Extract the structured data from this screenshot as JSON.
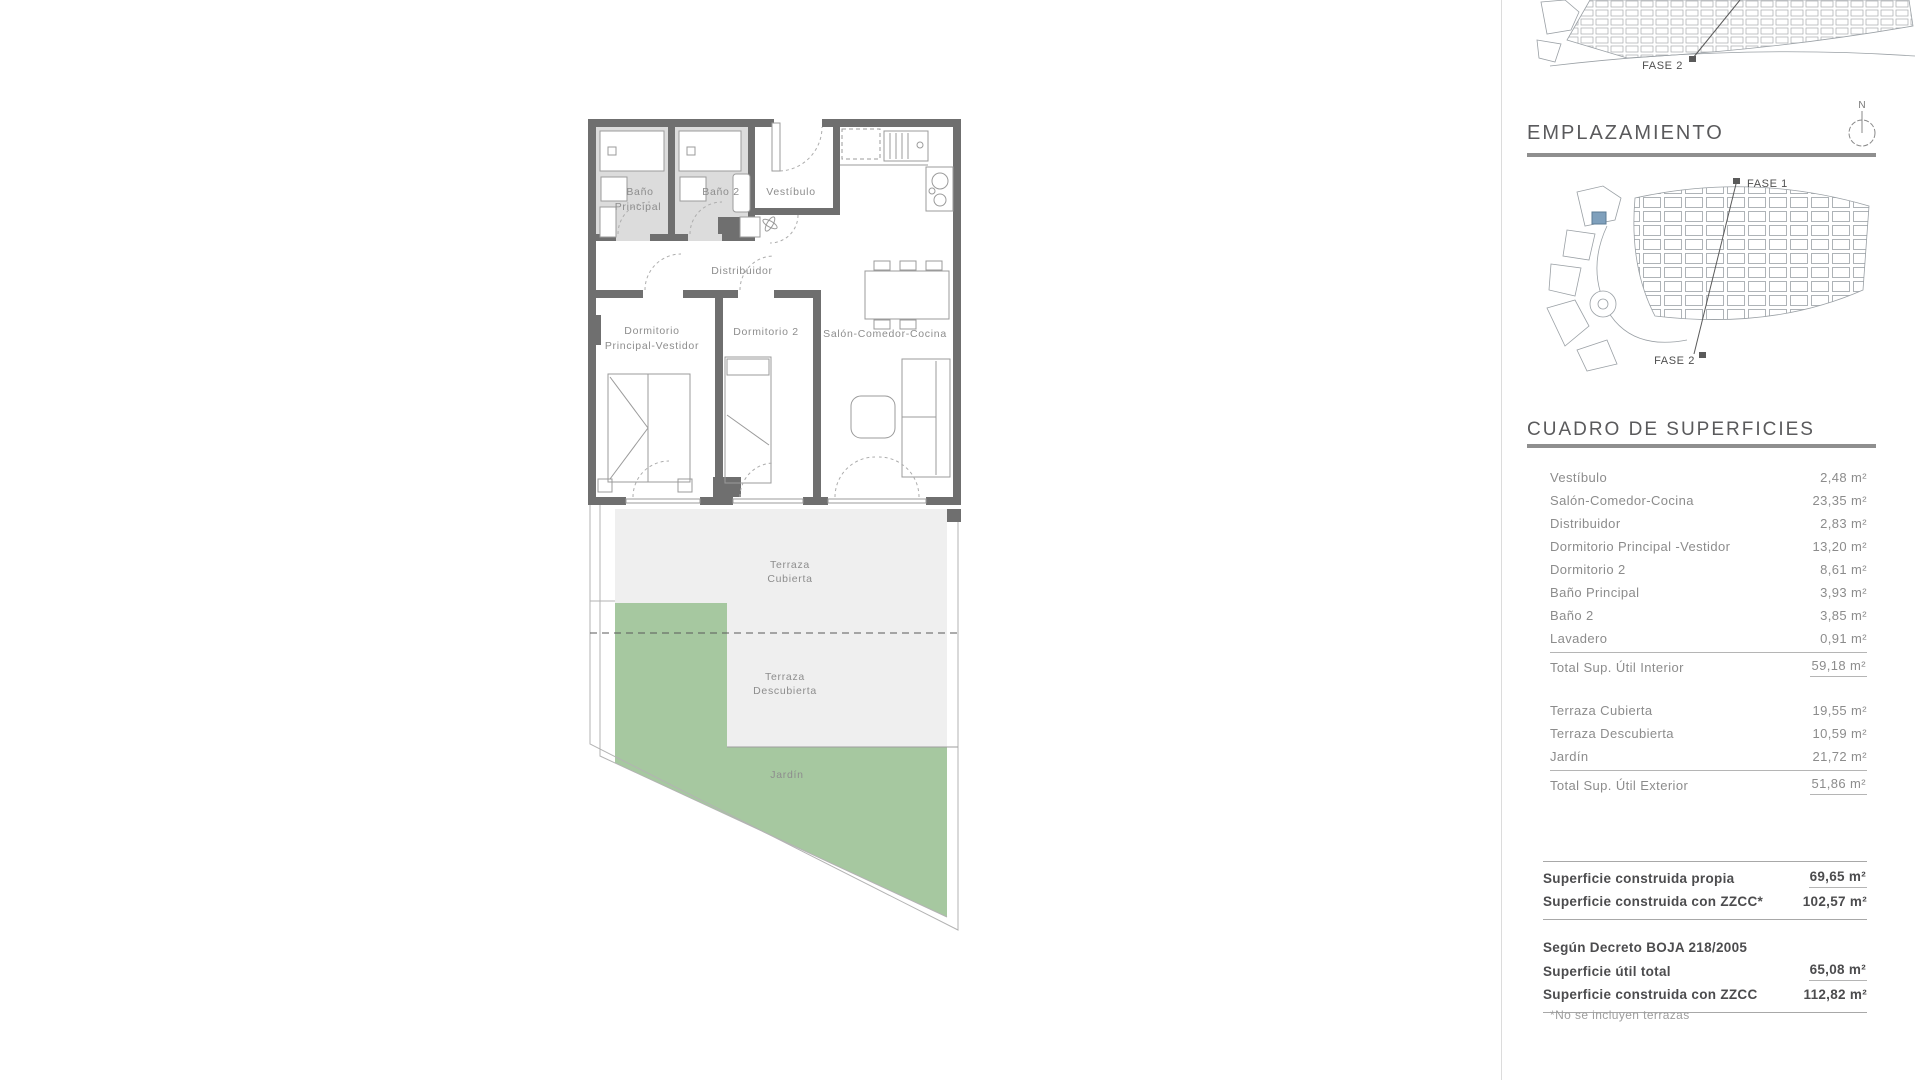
{
  "floor_plan": {
    "rooms": {
      "bano_principal_l1": "Baño",
      "bano_principal_l2": "Principal",
      "bano2": "Baño 2",
      "vestibulo": "Vestíbulo",
      "distribuidor": "Distribuidor",
      "dorm_principal_l1": "Dormitorio",
      "dorm_principal_l2": "Principal-Vestidor",
      "dorm2": "Dormitorio 2",
      "salon": "Salón-Comedor-Cocina",
      "terraza_cubierta_l1": "Terraza",
      "terraza_cubierta_l2": "Cubierta",
      "terraza_descubierta_l1": "Terraza",
      "terraza_descubierta_l2": "Descubierta",
      "jardin": "Jardín"
    }
  },
  "site": {
    "top_map_fase2": "FASE 2",
    "emplazamiento_title": "EMPLAZAMIENTO",
    "north_label": "N",
    "fase1": "FASE 1",
    "fase2": "FASE 2"
  },
  "surfaces": {
    "title": "CUADRO DE SUPERFICIES",
    "interior": {
      "rows": [
        {
          "label": "Vestíbulo",
          "value": "2,48 m²"
        },
        {
          "label": "Salón-Comedor-Cocina",
          "value": "23,35 m²"
        },
        {
          "label": "Distribuidor",
          "value": "2,83 m²"
        },
        {
          "label": "Dormitorio Principal -Vestidor",
          "value": "13,20 m²"
        },
        {
          "label": "Dormitorio 2",
          "value": "8,61 m²"
        },
        {
          "label": "Baño Principal",
          "value": "3,93 m²"
        },
        {
          "label": "Baño 2",
          "value": "3,85 m²"
        },
        {
          "label": "Lavadero",
          "value": "0,91 m²"
        }
      ],
      "total": {
        "label": "Total Sup. Útil Interior",
        "value": "59,18 m²"
      }
    },
    "exterior": {
      "rows": [
        {
          "label": "Terraza Cubierta",
          "value": "19,55 m²"
        },
        {
          "label": "Terraza Descubierta",
          "value": "10,59 m²"
        },
        {
          "label": "Jardín",
          "value": "21,72 m²"
        }
      ],
      "total": {
        "label": "Total Sup. Útil Exterior",
        "value": "51,86 m²"
      }
    },
    "construida": {
      "rows": [
        {
          "label": "Superficie construida propia",
          "value": "69,65 m²"
        },
        {
          "label": "Superficie construida con ZZCC*",
          "value": "102,57 m²"
        }
      ]
    },
    "decreto": {
      "heading": "Según Decreto BOJA 218/2005",
      "rows": [
        {
          "label": "Superficie útil total",
          "value": "65,08 m²"
        },
        {
          "label": "Superficie construida con ZZCC",
          "value": "112,82 m²"
        }
      ]
    },
    "footnote": "*No se incluyen terrazas"
  },
  "colors": {
    "accent_blue": "#7fa0bc",
    "wall_gray": "#6f6f6f",
    "bath_floor": "#dcdcdc",
    "terrace_gray": "#efefef",
    "garden_green": "#a6c8a0"
  }
}
